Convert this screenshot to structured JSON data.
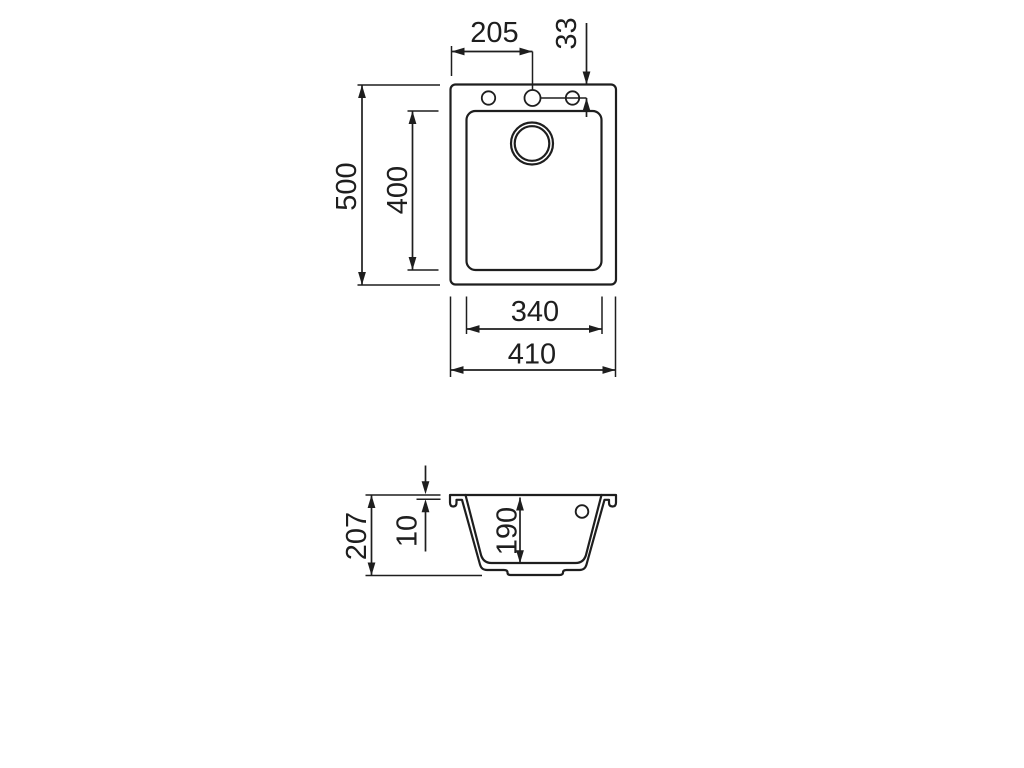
{
  "drawing": {
    "background": "#ffffff",
    "line_color": "#1e1e1e",
    "top_view": {
      "dims": {
        "faucet_hole_offset_x": "205",
        "faucet_hole_offset_y": "33",
        "overall_depth": "500",
        "bowl_depth_plan": "400",
        "bowl_width": "340",
        "overall_width": "410"
      }
    },
    "section_view": {
      "dims": {
        "overall_height": "207",
        "rim_thickness": "10",
        "bowl_inner_depth": "190"
      }
    }
  }
}
